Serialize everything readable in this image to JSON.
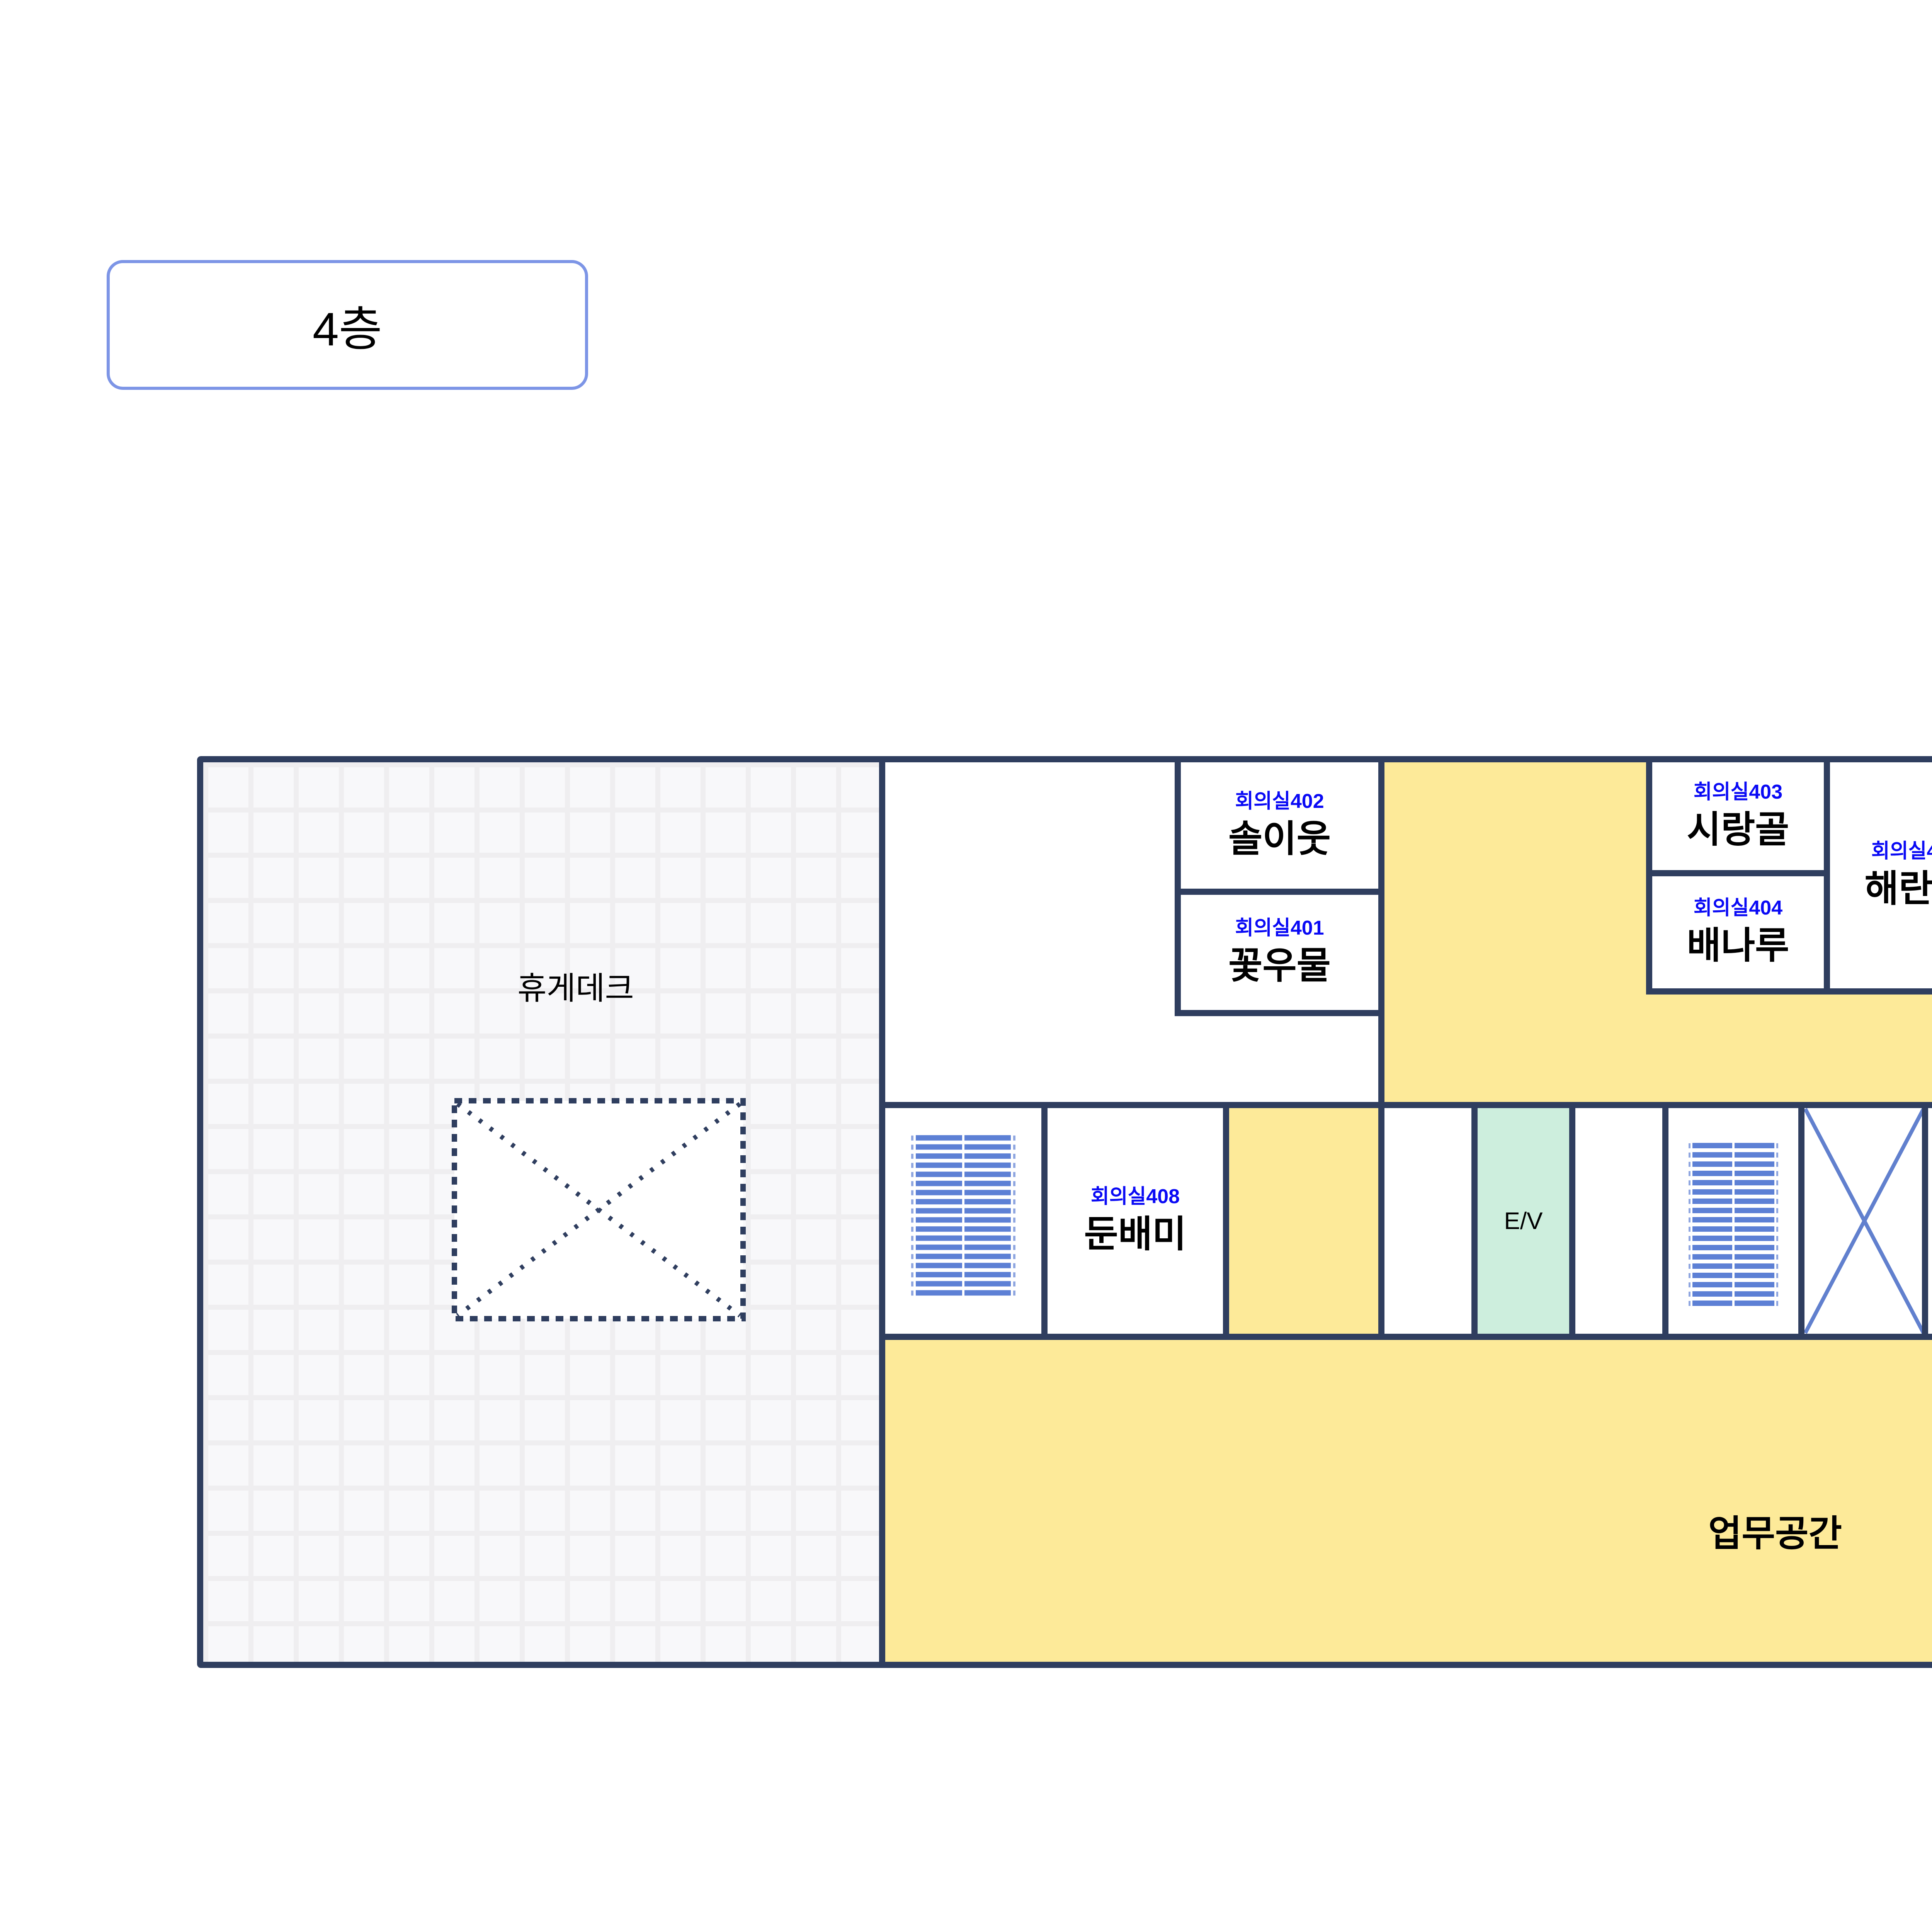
{
  "title": "4층",
  "floor_plan": {
    "deck": {
      "label": "휴게데크"
    },
    "rooms": {
      "m402": {
        "code": "회의실402",
        "name": "솔이웃"
      },
      "m401": {
        "code": "회의실401",
        "name": "꽃우물"
      },
      "m403": {
        "code": "회의실403",
        "name": "시랑골"
      },
      "m404": {
        "code": "회의실404",
        "name": "배나루"
      },
      "m405": {
        "code": "회의실405",
        "name": "해란뜰"
      },
      "m406": {
        "code": "회의실406",
        "name": "갯드레"
      },
      "m407": {
        "code": "회의실407",
        "name": "노리울"
      },
      "m408": {
        "code": "회의실408",
        "name": "둔배미"
      },
      "archive": {
        "name": "자료보관실"
      },
      "restroom": {
        "name": "화장실"
      },
      "elevator": {
        "name": "E/V"
      },
      "workspace": {
        "name": "업무공간"
      }
    },
    "colors": {
      "wall": "#2f3e5f",
      "corridor_fill": "#fdea99",
      "archive_fill": "#dde2f4",
      "elevator_fill": "#cdeedd",
      "restroom_fill": "#b3b3b3",
      "room_code_text": "#0a0af5",
      "room_name_text": "#000000",
      "stairs": "#5d80d5",
      "void_x": "#6180ce",
      "title_border": "#7d95e6",
      "deck_grid_line": "#efeef0"
    }
  }
}
